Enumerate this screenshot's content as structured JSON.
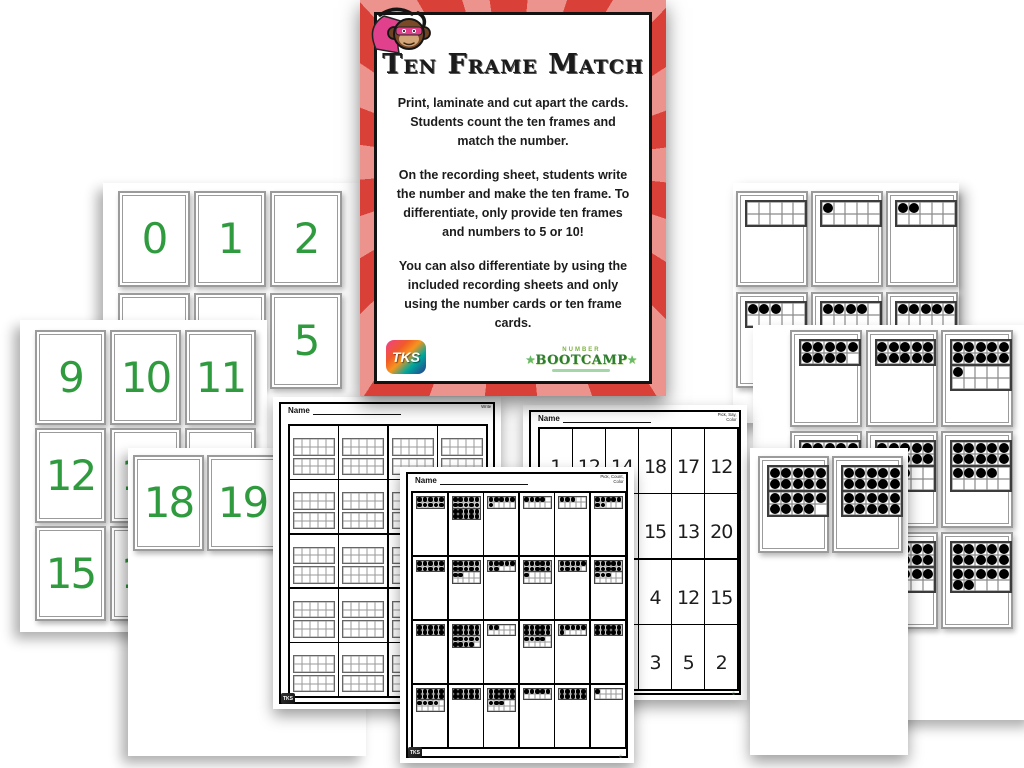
{
  "instruction_card": {
    "title": "Ten Frame Match",
    "paragraphs": [
      "Print, laminate and cut apart the cards. Students count the ten frames and match the number.",
      "On the recording sheet, students write the number and make the ten frame. To differentiate, only provide ten frames and numbers to 5 or 10!",
      "You can also differentiate by using the included recording sheets and only using the number cards or ten frame cards."
    ],
    "tks_logo_text": "TKS",
    "bootcamp_logo": {
      "line1": "NUMBER",
      "line2": "BOOTCAMP",
      "star": "★"
    },
    "colors": {
      "stripe_red": "#d94138",
      "stripe_pink": "#eb938c",
      "number_green": "#2f9b3e"
    }
  },
  "number_cards": {
    "back_sheet_values": [
      "0",
      "1",
      "2",
      "3",
      "4",
      "5"
    ],
    "middle_sheet_values": [
      "9",
      "10",
      "11",
      "12",
      "13",
      "14",
      "15",
      "16",
      "17"
    ],
    "front_sheet_values": [
      "18",
      "19"
    ]
  },
  "ten_frame_cards": {
    "back_sheet_values": [
      0,
      1,
      2,
      3,
      4,
      5
    ],
    "middle_sheet_values": [
      9,
      10,
      11,
      12,
      13,
      14,
      15,
      16,
      17
    ],
    "front_sheet_values": [
      19,
      20
    ]
  },
  "recording_sheets": {
    "blank_frames": {
      "name_label": "Name",
      "corner_label": "Write",
      "rows": 5,
      "cols": 4,
      "tks": "TKS"
    },
    "numbers": {
      "name_label": "Name",
      "corner_label_line1": "Pick, Say,",
      "corner_label_line2": "Color",
      "grid": [
        [
          "1",
          "12",
          "14",
          "18",
          "17",
          "12"
        ],
        [
          "",
          "",
          "",
          "15",
          "13",
          "20"
        ],
        [
          "",
          "",
          "",
          "4",
          "12",
          "15"
        ],
        [
          "",
          "",
          "",
          "3",
          "5",
          "2"
        ]
      ],
      "fineprint": "©"
    },
    "frames": {
      "name_label": "Name",
      "corner_label_line1": "Pick, Count,",
      "corner_label_line2": "Color",
      "grid": [
        [
          10,
          20,
          6,
          4,
          3,
          7
        ],
        [
          10,
          12,
          7,
          11,
          9,
          13
        ],
        [
          10,
          19,
          2,
          14,
          6,
          10
        ],
        [
          14,
          10,
          13,
          5,
          10,
          1
        ]
      ],
      "tks": "TKS",
      "fineprint": "©"
    }
  }
}
